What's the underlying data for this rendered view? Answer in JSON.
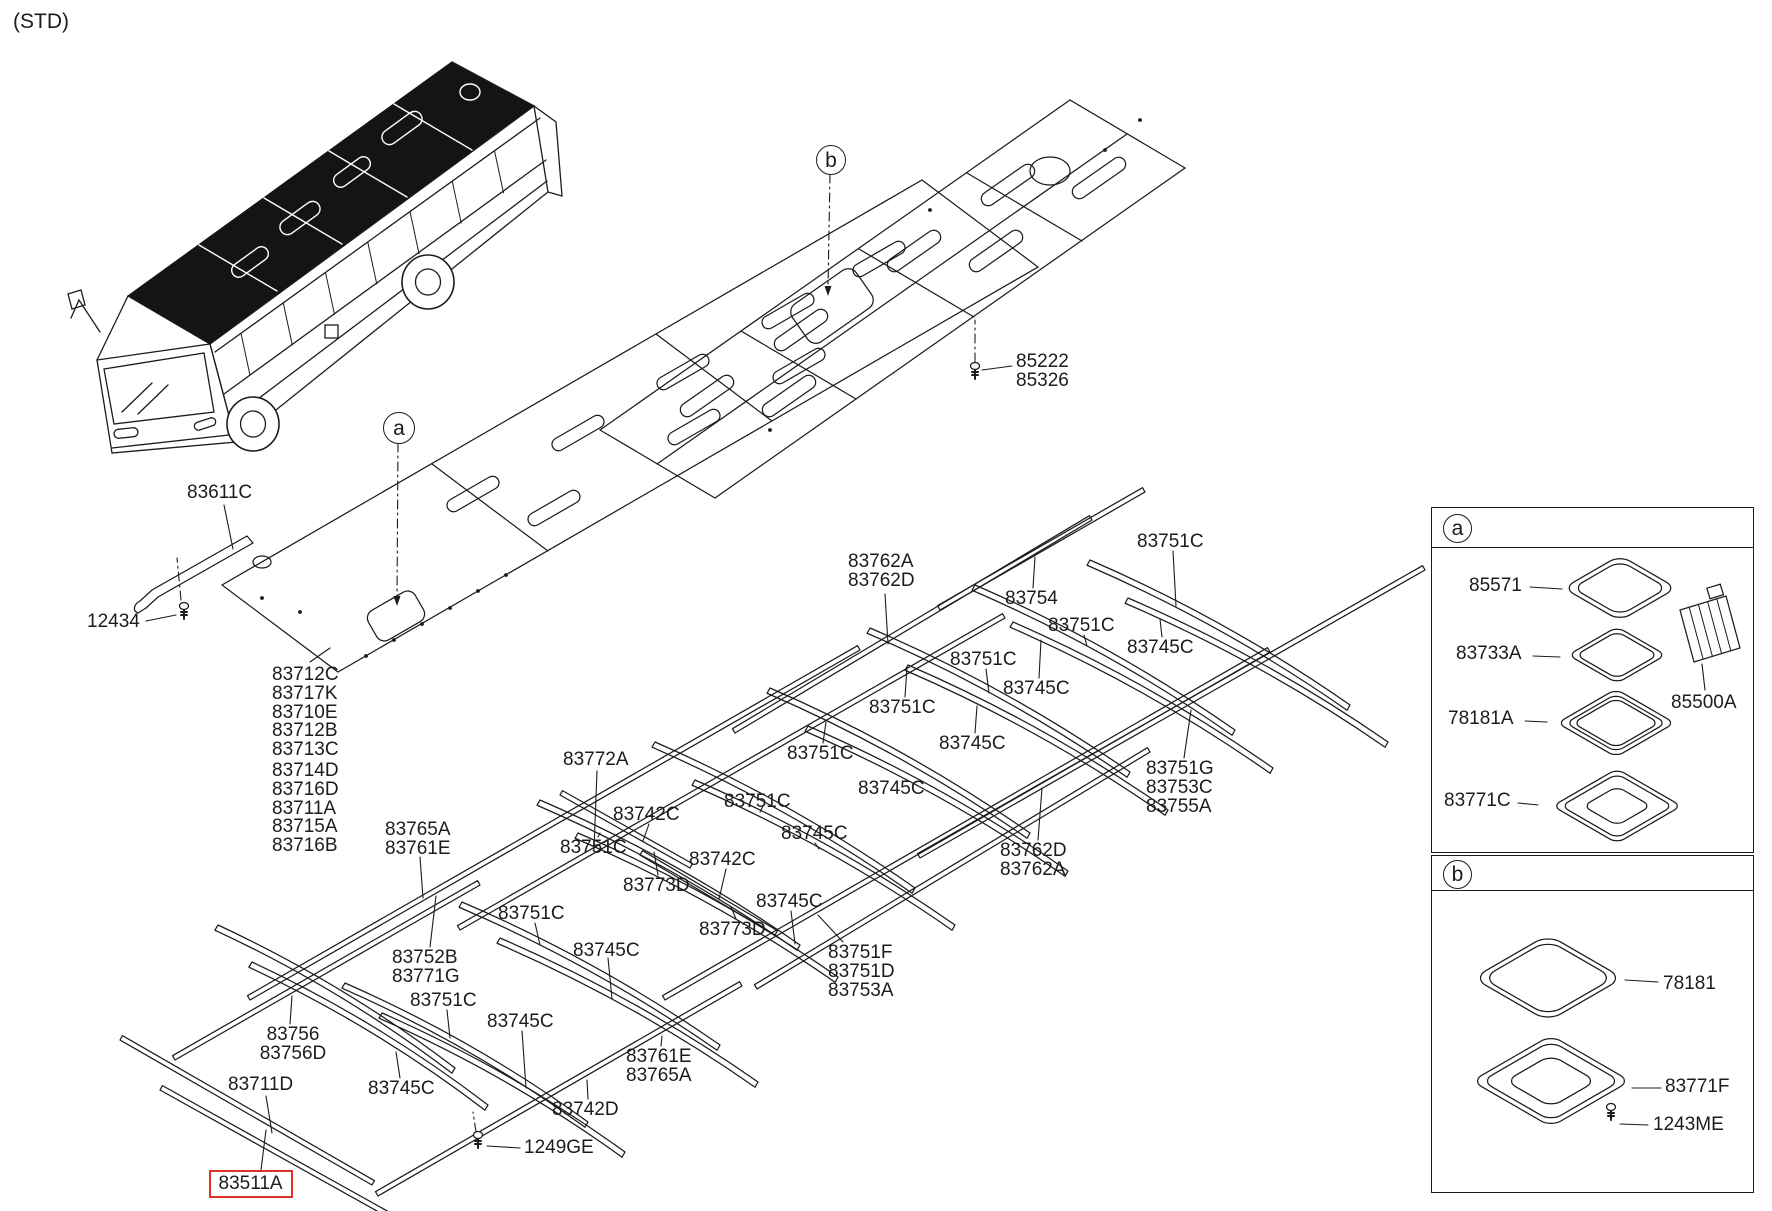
{
  "page": {
    "variant": "(STD)"
  },
  "colors": {
    "line": "#1c1c1c",
    "text": "#1c1c1c",
    "highlight": "#e0322b",
    "background": "#ffffff"
  },
  "callouts": {
    "main_a": "a",
    "main_b": "b",
    "inset_a": "a",
    "inset_b": "b"
  },
  "part_labels": [
    {
      "id": "83611C",
      "text": "83611C",
      "x": 187,
      "y": 484
    },
    {
      "id": "12434",
      "text": "12434",
      "x": 87,
      "y": 613
    },
    {
      "id": "85222-85326",
      "text": "85222\n85326",
      "x": 1016,
      "y": 353
    },
    {
      "id": "panel-list-1",
      "text": "83712C\n83717K\n83710E\n83712B\n83713C",
      "x": 272,
      "y": 666
    },
    {
      "id": "panel-list-2",
      "text": "83714D\n83716D\n83711A\n83715A\n83716B",
      "x": 272,
      "y": 762
    },
    {
      "id": "83765A-83761E",
      "text": "83765A\n83761E",
      "x": 385,
      "y": 821
    },
    {
      "id": "83752B-83771G",
      "text": "83752B\n83771G",
      "x": 392,
      "y": 949
    },
    {
      "id": "83751C-1",
      "text": "83751C",
      "x": 410,
      "y": 992
    },
    {
      "id": "83745C-1",
      "text": "83745C",
      "x": 487,
      "y": 1013
    },
    {
      "id": "83756-83756D",
      "text": "83756\n83756D",
      "x": 256,
      "y": 1026,
      "align": "center",
      "w": 74
    },
    {
      "id": "83711D",
      "text": "83711D",
      "x": 228,
      "y": 1076
    },
    {
      "id": "83745C-2",
      "text": "83745C",
      "x": 368,
      "y": 1080
    },
    {
      "id": "83511A",
      "text": "83511A",
      "x": 219,
      "y": 1176,
      "highlight": true
    },
    {
      "id": "1249GE",
      "text": "1249GE",
      "x": 524,
      "y": 1139
    },
    {
      "id": "83742D",
      "text": "83742D",
      "x": 552,
      "y": 1101
    },
    {
      "id": "83761E-83765A",
      "text": "83761E\n83765A",
      "x": 626,
      "y": 1048
    },
    {
      "id": "83751F-group",
      "text": "83751F\n83751D\n83753A",
      "x": 828,
      "y": 944
    },
    {
      "id": "83772A",
      "text": "83772A",
      "x": 563,
      "y": 751
    },
    {
      "id": "83742C-1",
      "text": "83742C",
      "x": 613,
      "y": 806
    },
    {
      "id": "83751C-2",
      "text": "83751C",
      "x": 560,
      "y": 839
    },
    {
      "id": "83773D-1",
      "text": "83773D",
      "x": 623,
      "y": 877
    },
    {
      "id": "83742C-2",
      "text": "83742C",
      "x": 689,
      "y": 851
    },
    {
      "id": "83773D-2",
      "text": "83773D",
      "x": 699,
      "y": 921
    },
    {
      "id": "83745C-3",
      "text": "83745C",
      "x": 573,
      "y": 942
    },
    {
      "id": "83751C-3",
      "text": "83751C",
      "x": 498,
      "y": 905
    },
    {
      "id": "83751C-4",
      "text": "83751C",
      "x": 724,
      "y": 793
    },
    {
      "id": "83745C-4",
      "text": "83745C",
      "x": 756,
      "y": 893
    },
    {
      "id": "83751C-5",
      "text": "83751C",
      "x": 787,
      "y": 745
    },
    {
      "id": "83745C-5",
      "text": "83745C",
      "x": 781,
      "y": 825
    },
    {
      "id": "83762A-83762D",
      "text": "83762A\n83762D",
      "x": 848,
      "y": 553
    },
    {
      "id": "83754",
      "text": "83754",
      "x": 1005,
      "y": 590
    },
    {
      "id": "83751C-6",
      "text": "83751C",
      "x": 1137,
      "y": 533
    },
    {
      "id": "83745C-6",
      "text": "83745C",
      "x": 1127,
      "y": 639
    },
    {
      "id": "83751C-7",
      "text": "83751C",
      "x": 1048,
      "y": 617
    },
    {
      "id": "83745C-7",
      "text": "83745C",
      "x": 1003,
      "y": 680
    },
    {
      "id": "83751C-8",
      "text": "83751C",
      "x": 950,
      "y": 651
    },
    {
      "id": "83751C-9",
      "text": "83751C",
      "x": 869,
      "y": 699
    },
    {
      "id": "83745C-8",
      "text": "83745C",
      "x": 939,
      "y": 735
    },
    {
      "id": "83745C-9",
      "text": "83745C",
      "x": 858,
      "y": 780
    },
    {
      "id": "83751G-group",
      "text": "83751G\n83753C\n83755A",
      "x": 1146,
      "y": 760
    },
    {
      "id": "83762D-83762A",
      "text": "83762D\n83762A",
      "x": 1000,
      "y": 842
    },
    {
      "id": "85571",
      "text": "85571",
      "x": 1469,
      "y": 577
    },
    {
      "id": "83733A",
      "text": "83733A",
      "x": 1456,
      "y": 645
    },
    {
      "id": "78181A",
      "text": "78181A",
      "x": 1448,
      "y": 710
    },
    {
      "id": "83771C",
      "text": "83771C",
      "x": 1444,
      "y": 792
    },
    {
      "id": "85500A",
      "text": "85500A",
      "x": 1671,
      "y": 694
    },
    {
      "id": "78181",
      "text": "78181",
      "x": 1663,
      "y": 975
    },
    {
      "id": "83771F",
      "text": "83771F",
      "x": 1665,
      "y": 1078
    },
    {
      "id": "1243ME",
      "text": "1243ME",
      "x": 1653,
      "y": 1116
    }
  ]
}
